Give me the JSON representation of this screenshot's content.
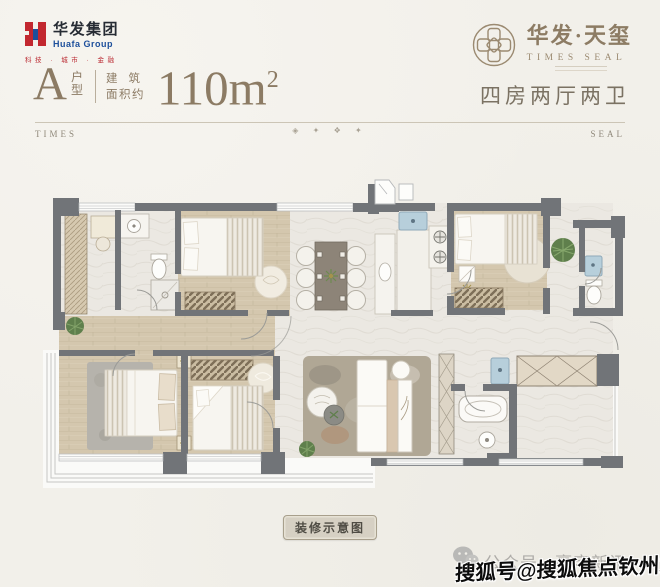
{
  "header": {
    "brand_left": {
      "name_cn": "华发集团",
      "name_en": "Huafa Group",
      "tagline": "科技 · 城市 · 金融",
      "brand_red": "#c2272f",
      "brand_blue": "#1d4f9b"
    },
    "brand_right": {
      "name_cn": "华发·天玺",
      "name_en": "TIMES SEAL",
      "bronze": "#8d7c64"
    }
  },
  "title": {
    "unit_letter": "A",
    "unit_suffix_top": "户",
    "unit_suffix_bottom": "型",
    "area_label_line1": "建筑",
    "area_label_line2": "面积约",
    "area_value": "110m",
    "area_sup": "2",
    "layout_desc": "四房两厅两卫"
  },
  "divider": {
    "left_label": "TIMES",
    "right_label": "SEAL",
    "ornaments": "◈ ✦ ❖ ✦"
  },
  "floor_plan": {
    "caption": "装修示意图",
    "palette": {
      "wall_gray": "#717478",
      "wood_floor": "#d4c7ae",
      "marble_floor": "#ebe8e2",
      "water_blue": "#b7cfdb",
      "plant_green": "#5f7f4c",
      "accent_beige": "#d9c7b0",
      "gold": "#a5924e"
    }
  },
  "footer": {
    "account_label": "公众号 · 豪宅新讯",
    "watermark": "搜狐号@搜狐焦点钦州站",
    "watermark_color": "#0c0c0c"
  }
}
